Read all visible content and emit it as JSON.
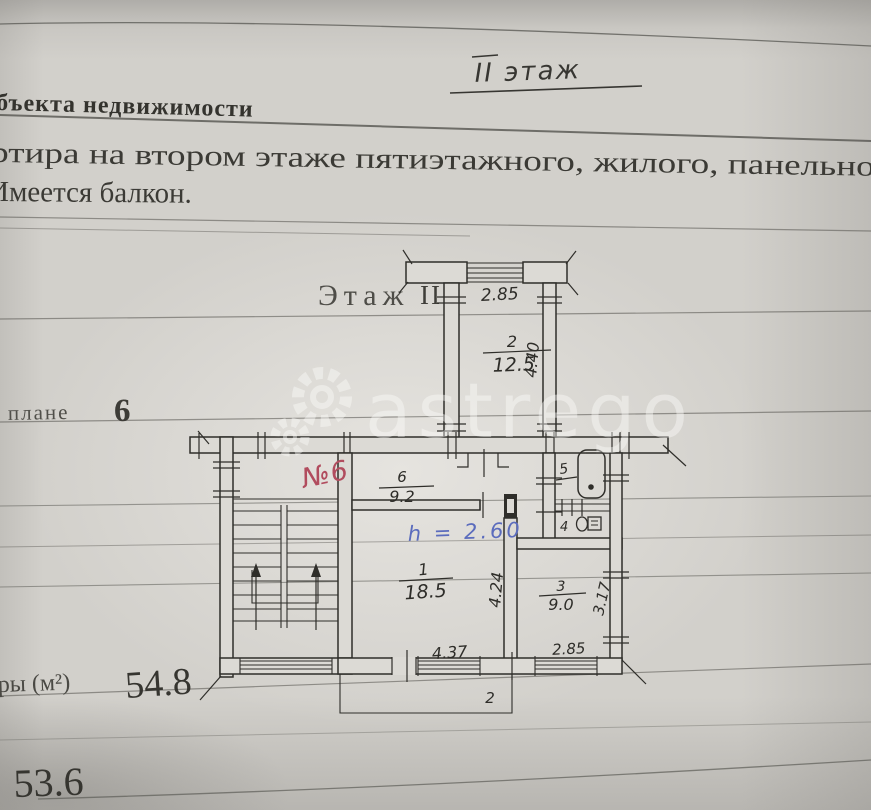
{
  "document": {
    "handwritten_floor_note": "II этаж",
    "section_heading": "бъекта недвижимости",
    "description_line1": "ртира на втором этаже пятиэтажного, жилого, панельног",
    "description_line2": "Имеется балкон.",
    "floor_caption": "Этаж",
    "floor_number": "II",
    "plan_note_caption": "плане",
    "plan_note_number": "6",
    "area_row_caption": "ры (м²)",
    "area_total": "54.8",
    "area_secondary": "53.6"
  },
  "plan": {
    "balcony_top": {
      "width": "2.85"
    },
    "room_top": {
      "number": "2",
      "area": "12.5",
      "depth": "4.40"
    },
    "hall": {
      "number": "6",
      "area": "9.2"
    },
    "room_main": {
      "number": "1",
      "area": "18.5",
      "width": "4.37",
      "depth": "4.24"
    },
    "room_small": {
      "number": "3",
      "area": "9.0",
      "width": "2.85",
      "depth": "3.17"
    },
    "bathroom": {
      "number": "5"
    },
    "toilet": {
      "number": "4"
    },
    "balcony_bottom": {
      "number": "2"
    },
    "handwritten_red_note": "№6",
    "handwritten_blue_note": "h = 2.60"
  },
  "watermark": {
    "text": "astrego"
  }
}
